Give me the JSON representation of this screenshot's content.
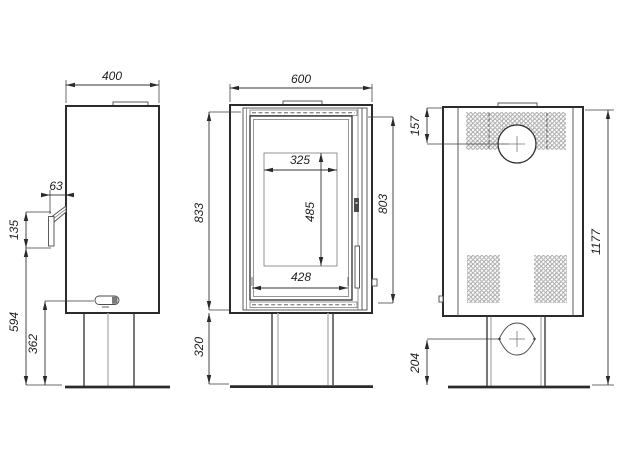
{
  "drawing": {
    "type": "stove-three-view-technical-drawing",
    "views": {
      "side": {
        "dims": {
          "width": "400",
          "handle_depth": "63",
          "handle_height": "135",
          "handle_to_floor": "594",
          "lever_to_floor": "362"
        }
      },
      "front": {
        "dims": {
          "width": "600",
          "body_height": "833",
          "pedestal_height": "320",
          "door_height": "803",
          "glass_width": "325",
          "glass_height": "485",
          "door_width": "428"
        }
      },
      "back": {
        "dims": {
          "flue_center_from_top": "157",
          "total_height": "1177",
          "inlet_center_from_floor": "204"
        }
      }
    },
    "colors": {
      "line": "#2b2b2b",
      "dimension_text": "#1e1e1e",
      "perforation": "#9a9a9a",
      "lip_fill": "#c4c4c4",
      "background": "#ffffff"
    }
  }
}
